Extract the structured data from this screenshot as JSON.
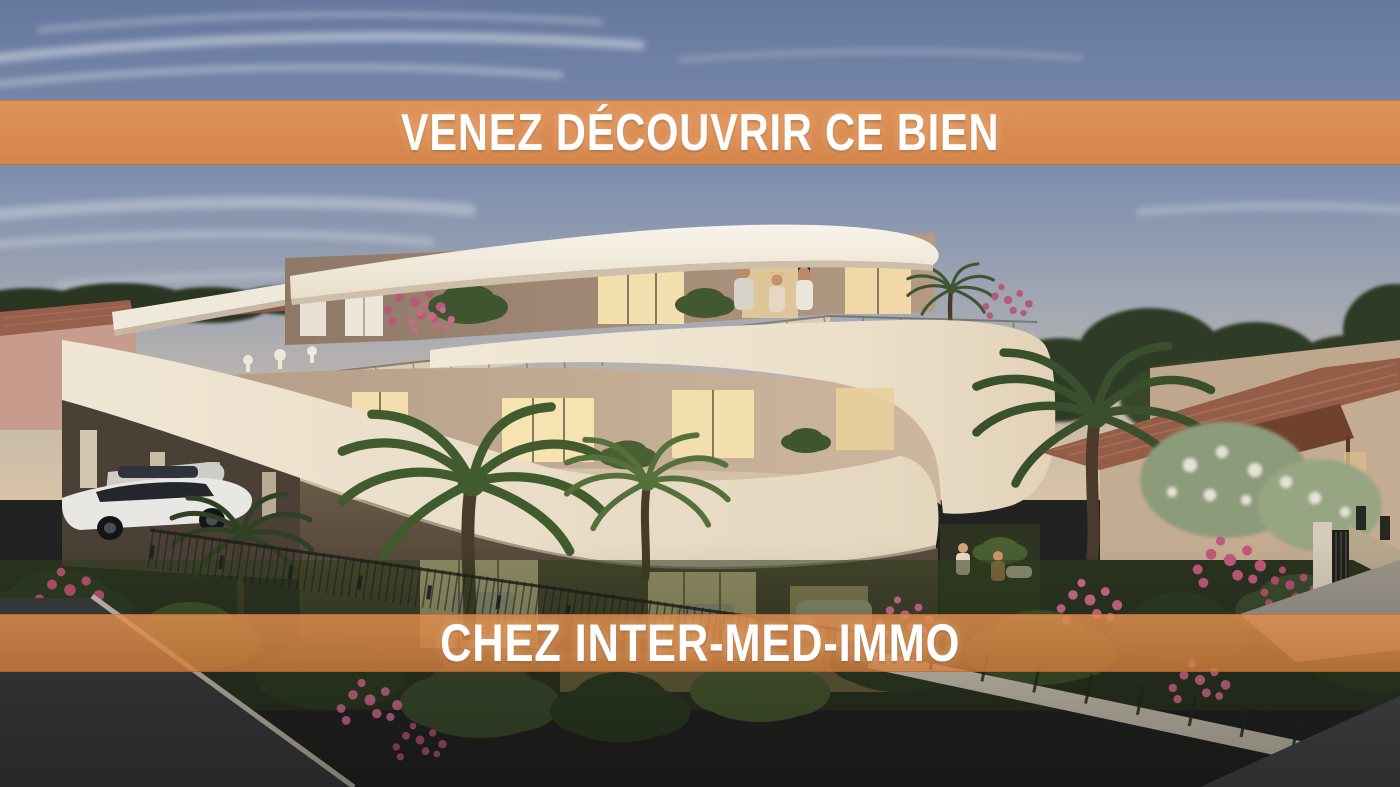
{
  "meta": {
    "kind": "real-estate promotional rendering",
    "width_px": 1400,
    "height_px": 787
  },
  "banners": {
    "top": {
      "text": "VENEZ DÉCOUVRIR CE BIEN",
      "background": "#DE8D52",
      "opacity": 0.96,
      "text_color": "#FFFFFF"
    },
    "bottom": {
      "text": "CHEZ INTER-MED-IMMO",
      "background": "#DD8A4B",
      "opacity": 0.82,
      "text_color": "#FFFFFF"
    }
  },
  "scene": {
    "description": "Dusk 3D rendering of a modern three-storey Mediterranean apartment residence with sweeping curved cream balcony bands, a roof terrace with three people, warm lit interiors, a carport with white cars, palm trees, a flowering garden behind a dark iron fence, neighbouring terracotta-roofed houses and an asphalt street in the foreground",
    "people": {
      "roof_terrace": 3,
      "garden_patio": 2
    },
    "palette": {
      "sky_top": "#66789E",
      "sky_horizon": "#D8C3A8",
      "banner_orange": "#DE8D52",
      "balcony_cream": "#EFE5D2",
      "roof_white": "#F5F1E8",
      "wall_taupe": "#9A8470",
      "wall_beige": "#C3AD94",
      "window_glow": "#F3DFAE",
      "terracotta_roof": "#935D48",
      "awning_brown": "#70422E",
      "foliage_dark": "#2C3A22",
      "foliage_mid": "#55683A",
      "flower_pink": "#C9688A",
      "road_asphalt": "#3A3B3D",
      "fence_dark": "#1E201B",
      "car_white": "#E9E7E3"
    }
  }
}
